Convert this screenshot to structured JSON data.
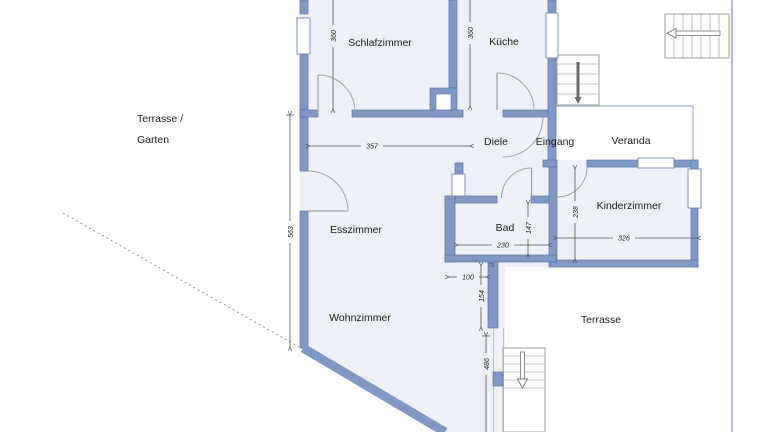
{
  "rooms": {
    "schlafzimmer": {
      "label": "Schlafzimmer"
    },
    "kueche": {
      "label": "Küche"
    },
    "diele": {
      "label": "Diele"
    },
    "eingang": {
      "label": "Eingang"
    },
    "veranda": {
      "label": "Veranda"
    },
    "kinderzimmer": {
      "label": "Kinderzimmer"
    },
    "esszimmer": {
      "label": "Esszimmer"
    },
    "bad": {
      "label": "Bad"
    },
    "wohnzimmer": {
      "label": "Wohnzimmer"
    }
  },
  "outdoor": {
    "terrasse_garten_line1": "Terrasse /",
    "terrasse_garten_line2": "Garten",
    "terrasse": "Terrasse"
  },
  "dimensions_cm": {
    "schlafzimmer_height": "360",
    "kueche_height": "360",
    "corridor_width": "357",
    "esszimmer_height": "563",
    "kinderzimmer_height": "238",
    "kinderzimmer_width": "326",
    "bad_width": "230",
    "bad_height": "147",
    "pier_offset": "100",
    "pier_height": "154",
    "terrace_length": "486",
    "pier_width": "73"
  },
  "colors": {
    "wall": "#8098c4",
    "wall_edge": "#5a75a6",
    "floor": "#edf1f7",
    "dimension": "#555555",
    "boundary": "#93a9cb",
    "background": "#ffffff"
  }
}
